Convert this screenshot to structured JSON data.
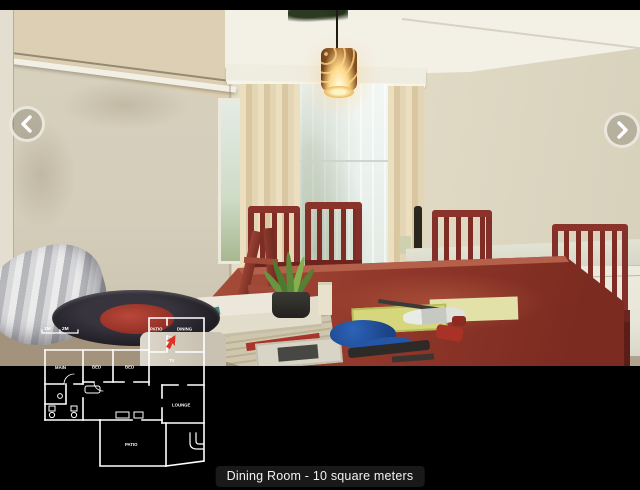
{
  "viewer": {
    "caption": "Dining Room - 10 square meters"
  },
  "nav": {
    "prev_icon": "chevron-left",
    "next_icon": "chevron-right"
  },
  "floorplan": {
    "scale": {
      "m1": "1M",
      "m2": "2M"
    },
    "rooms": {
      "patio_top": "PATIO",
      "dining": "DINING",
      "tv": "TV",
      "main": "MAIN",
      "bed1": "BED",
      "bed2": "BED",
      "lounge": "LOUNGE",
      "patio_bottom": "PATIO"
    },
    "marker": {
      "room": "DINING",
      "color": "#e03020"
    }
  },
  "palette": {
    "left_wall": "#d5cebb",
    "back_wall": "#e5dec9",
    "ceiling": "#f3f0e6",
    "curtain": "#e6dabb",
    "window_light": "#eef4f1",
    "table_wood": "#96402f",
    "chair_wood": "#7e2c24",
    "freezer": "#ebe9dc",
    "lamp_glow": "#ffd98a",
    "caption_bg": "#1c1c1c",
    "plan_lines": "#ffffff",
    "marker_red": "#e03020"
  }
}
